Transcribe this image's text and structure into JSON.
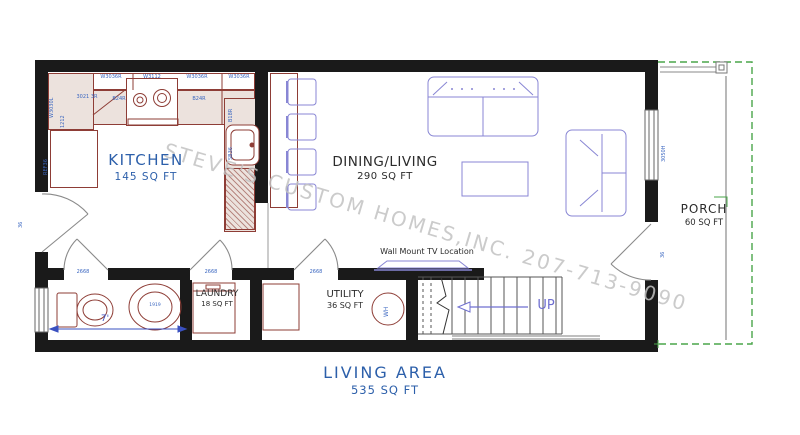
{
  "drawing": {
    "watermark": "STEVE'S CUSTOM HOMES,INC. 207-713-9090",
    "footer": {
      "name": "LIVING AREA",
      "area": "535 SQ FT"
    }
  },
  "rooms": {
    "kitchen": {
      "name": "KITCHEN",
      "area": "145 SQ FT"
    },
    "dining_living": {
      "name": "DINING/LIVING",
      "area": "290 SQ FT"
    },
    "laundry": {
      "name": "LAUNDRY",
      "area": "18 SQ FT"
    },
    "utility": {
      "name": "UTILITY",
      "area": "36 SQ FT"
    },
    "porch": {
      "name": "PORCH",
      "area": "60 SQ FT"
    }
  },
  "annotations": {
    "tv_location": "Wall Mount TV Location",
    "stairs_direction": "UP",
    "water_heater": "WH",
    "bath_width": "7'",
    "bath_sink_code": "1919"
  },
  "openings": {
    "interior_door_codes": [
      "2668",
      "2668",
      "2668"
    ],
    "left_door_code": "36",
    "porch_door_code": "36",
    "right_window_code": "3050H"
  },
  "cabinet_codes": {
    "upper_row": [
      "W3036R",
      "W3112",
      "W3036R",
      "W3036R"
    ],
    "counter_row": [
      "3021 3R",
      "B24R",
      "B24R"
    ],
    "left_column": [
      "W3030L",
      "1212",
      "REF36"
    ],
    "sink_column": [
      "B18R",
      "SB36"
    ]
  },
  "colors": {
    "wall": "#1a1a1a",
    "cabinet_outline": "#8e3d36",
    "furniture": "#8886d4",
    "room_label_blue": "#2c5faa",
    "room_label_dark": "#2b2b2b",
    "code_blue": "#3a66c0",
    "porch_green": "#4aa64a",
    "watermark_gray": "#c2c2c2"
  }
}
